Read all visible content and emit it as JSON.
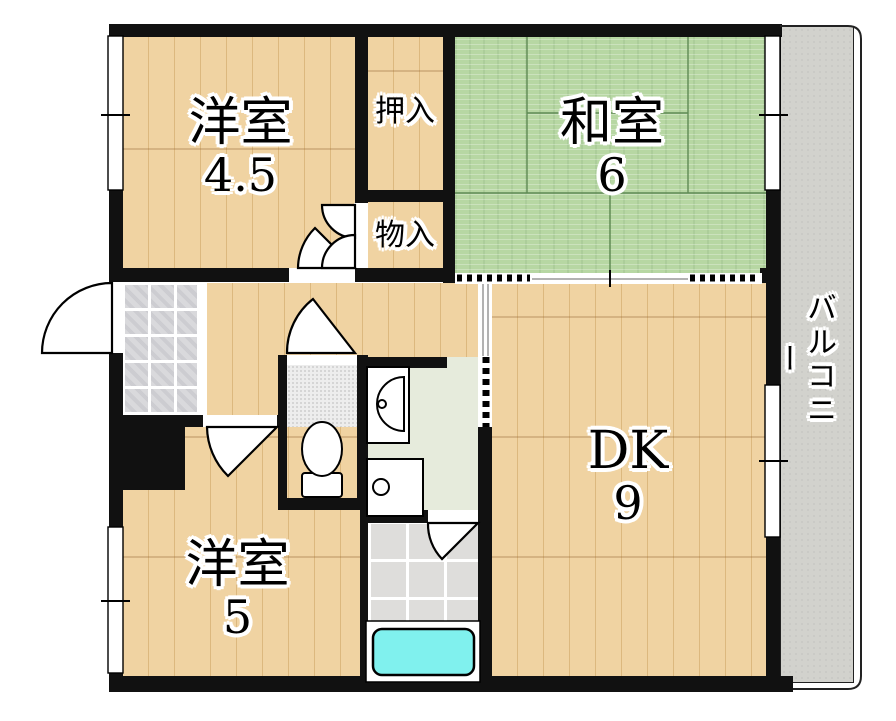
{
  "rooms": {
    "western45": {
      "name": "洋室",
      "area": "4.5"
    },
    "closet_oshiire": {
      "name": "押入"
    },
    "japanese6": {
      "name": "和室",
      "area": "6"
    },
    "closet_monoire": {
      "name": "物入"
    },
    "dk": {
      "name": "DK",
      "area": "9"
    },
    "western5": {
      "name": "洋室",
      "area": "5"
    },
    "balcony": {
      "name": "バルコニー"
    }
  },
  "fixtures": {
    "toilet": "toilet",
    "washbasin": "washbasin",
    "washing_machine_pan": "washing-machine-pan",
    "bathtub": "bathtub"
  },
  "colors": {
    "wall": "#111111",
    "wood": "#f0d3a2",
    "wood_line": "#dcb87e",
    "tatami": "#b7d7a3",
    "tatami_line": "#5f8a54",
    "balcony": "#d2d2cd",
    "tile": "#d9d9dc",
    "bath_floor": "#dedddb",
    "washroom_floor": "#e6ebdc",
    "toilet_floor": "#ededed",
    "bathtub": "#80f1ee",
    "outline": "#000000"
  }
}
